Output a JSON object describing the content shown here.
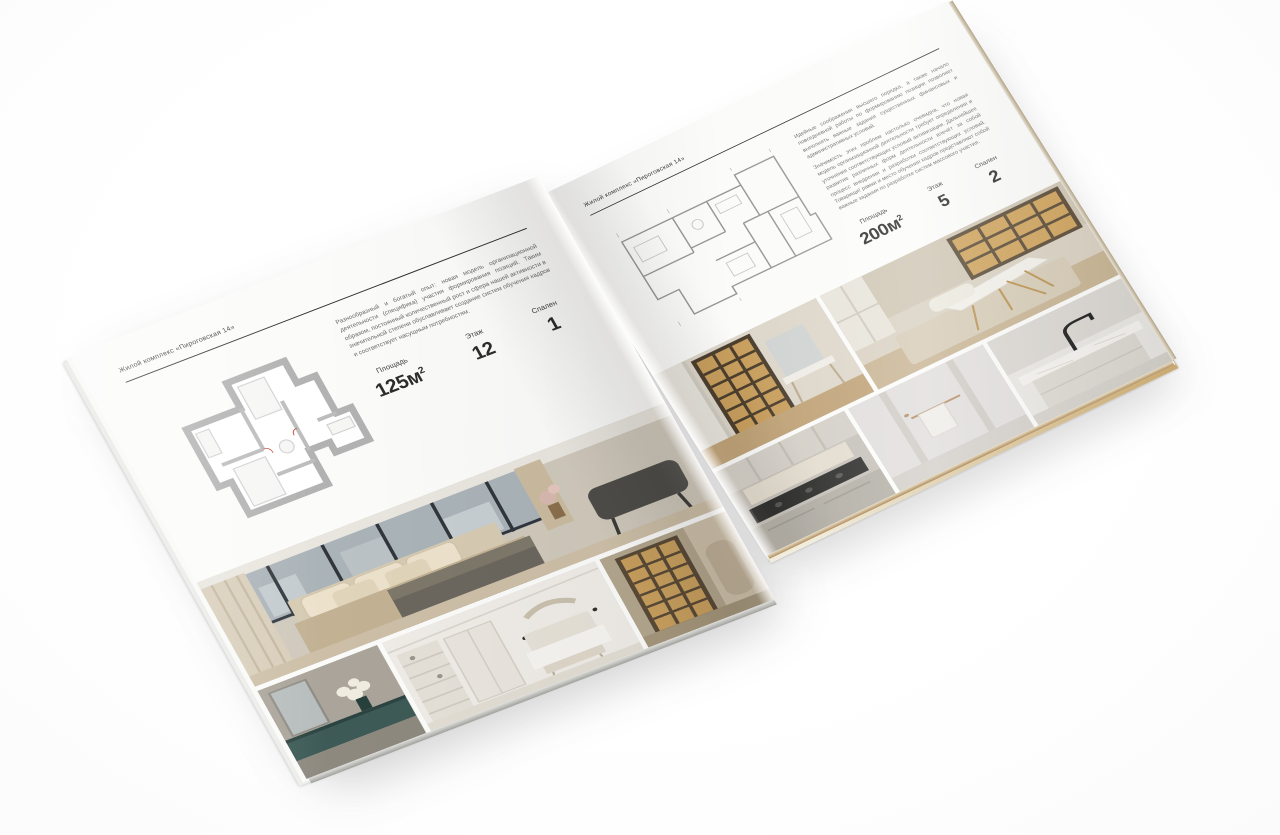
{
  "brochure": {
    "left_page": {
      "header": "Жилой комплекс «Пироговская 14»",
      "description": "Разнообразный и богатый опыт: новая модель организационной деятельности (специфика) участия формирования позиций. Таким образом, постоянный количественный рост и сфера нашей активности в значительной степени обуславливает создание систем обучения кадров и соответствует насущным потребностям.",
      "stats": [
        {
          "label": "Площадь",
          "value": "125м",
          "sup": "2"
        },
        {
          "label": "Этаж",
          "value": "12"
        },
        {
          "label": "Спален",
          "value": "1"
        }
      ],
      "photos": [
        "master-bedroom",
        "dresser-vignette",
        "white-bedroom",
        "hallway-bookshelf"
      ]
    },
    "right_page": {
      "header": "Жилой комплекс «Пироговская 14»",
      "description_1": "Идейные соображения высшего порядка, а также начало повседневной работы по формированию позиции позволяет выполнять важные задания существенных финансовых и административных условий.",
      "description_2": "Значимость этих проблем настолько очевидна, что новая модель организационной деятельности требует определения и уточнения соответствующих условий активизации. Дальнейшее развитие различных форм деятельности влечёт за собой процесс внедрения и разработки соответствующих условий. Товарищи! рамки и место обучения кадров представляют собой важные задания по разработке систем массового участия.",
      "stats": [
        {
          "label": "Площадь",
          "value": "200м",
          "sup": "2"
        },
        {
          "label": "Этаж",
          "value": "5"
        },
        {
          "label": "Спален",
          "value": "2"
        }
      ],
      "photos": [
        "corridor-bookcase",
        "home-office",
        "kitchen",
        "bathroom",
        "kitchen-island"
      ]
    },
    "colors": {
      "page_background": "#fbfbfa",
      "text_primary": "#2c2c2c",
      "header_rule": "#2f2f2f",
      "floorplan_wall": "#b2b2b2"
    }
  }
}
